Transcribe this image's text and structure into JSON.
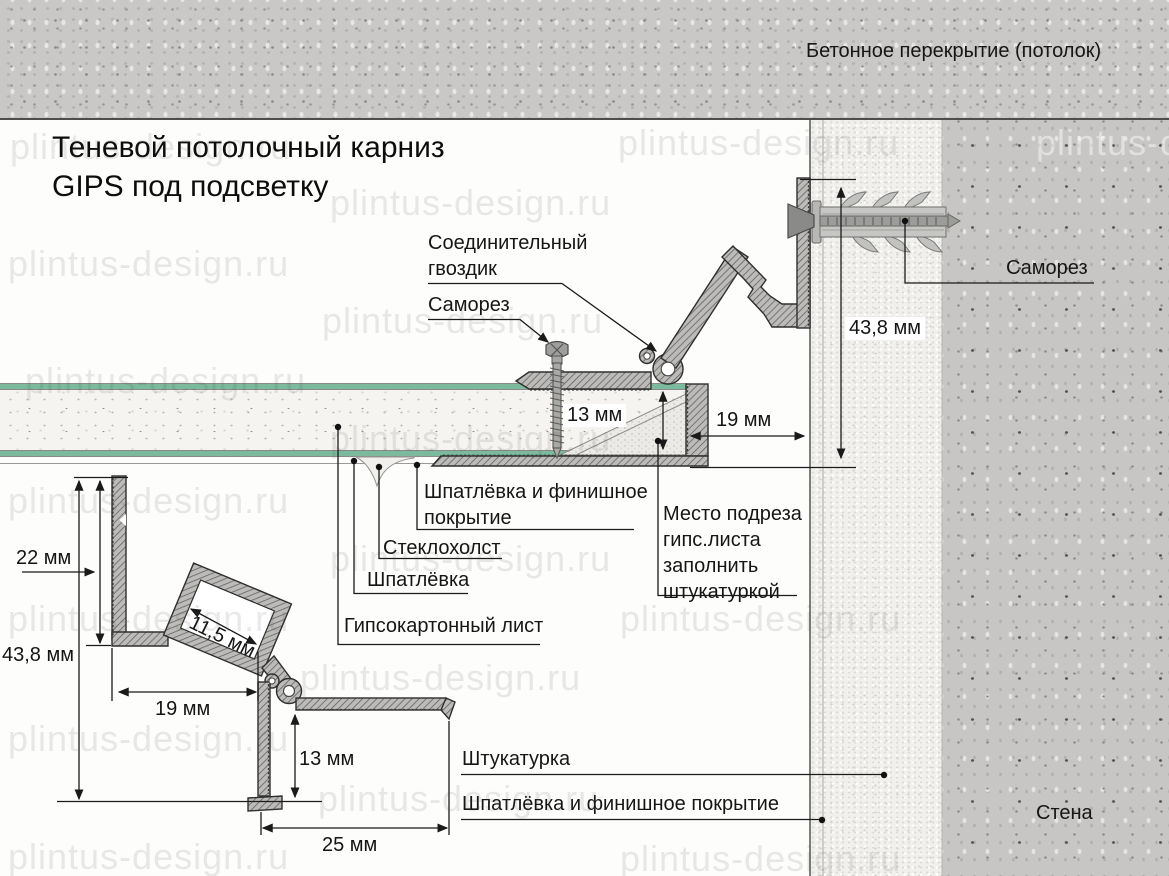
{
  "watermark": "plintus-design.ru",
  "title": [
    "Теневой потолочный карниз",
    "GIPS под подсветку"
  ],
  "labels": {
    "ceiling": "Бетонное перекрытие (потолок)",
    "wall": "Стена",
    "connector_nail": [
      "Соединительный",
      "гвоздик"
    ],
    "screw_center": "Саморез",
    "screw_wall": "Саморез",
    "putty_finish": [
      "Шпатлёвка и финишное",
      "покрытие"
    ],
    "fiberglass": "Стеклохолст",
    "putty": "Шпатлёвка",
    "drywall_sheet": "Гипсокартонный лист",
    "cut_area": [
      "Место подреза",
      "гипс.листа",
      "заполнить",
      "штукатуркой"
    ],
    "plaster": "Штукатурка",
    "putty_finish_full": "Шпатлёвка и финишное покрытие"
  },
  "dimensions": {
    "main": {
      "drywall_thickness": "13 мм",
      "gap_width": "19 мм",
      "total_height": "43,8 мм"
    },
    "detail": {
      "strip_height": "22 мм",
      "total_height": "43,8 мм",
      "channel_width": "11,5 мм",
      "base_width": "19 мм",
      "lip_height": "13 мм",
      "bottom_width": "25 мм"
    }
  },
  "colors": {
    "drywall_face_green": "#7cba9d",
    "ceiling_concrete": "#c9c8c6",
    "wall_concrete": "#c7c6c4",
    "plaster_coat": "#f1f0ed",
    "profile_outline": "#2f2f2e",
    "text": "#161616"
  }
}
